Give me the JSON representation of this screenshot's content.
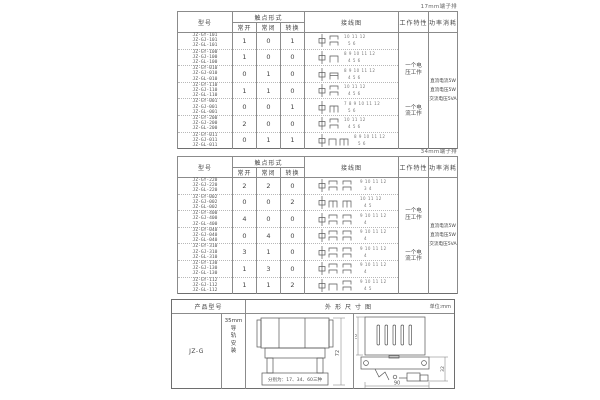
{
  "page": {
    "table1_tag": "17mm端子排",
    "table2_tag": "34mm端子排"
  },
  "headers": {
    "model": "型号",
    "contact_form": "触点形式",
    "normally_open": "常开",
    "normally_closed": "常闭",
    "changeover": "转换",
    "wiring_diagram": "接线图",
    "working_characteristic": "工作特性",
    "power_consumption": "功率消耗"
  },
  "table1": {
    "work_modes": [
      "一个电压工作",
      "一个电流工作"
    ],
    "power": [
      "直流电流5W",
      "直流电压5W",
      "交流电压5VA"
    ],
    "rows": [
      {
        "models": [
          "JZ-GY-101",
          "JZ-GJ-101",
          "JZ-GL-101"
        ],
        "no": 1,
        "nc": 0,
        "co": 1,
        "terminals_top": "10 11 12",
        "terminals_bottom": "5 6"
      },
      {
        "models": [
          "JZ-GY-100",
          "JZ-GJ-100",
          "JZ-GL-100"
        ],
        "no": 1,
        "nc": 0,
        "co": 0,
        "terminals_top": "8 9 10 11 12",
        "terminals_bottom": "4 5 6"
      },
      {
        "models": [
          "JZ-GY-010",
          "JZ-GJ-010",
          "JZ-GL-010"
        ],
        "no": 0,
        "nc": 1,
        "co": 0,
        "terminals_top": "8 9 10 11 12",
        "terminals_bottom": "4 5 6"
      },
      {
        "models": [
          "JZ-GY-110",
          "JZ-GJ-110",
          "JZ-GL-110"
        ],
        "no": 1,
        "nc": 1,
        "co": 0,
        "terminals_top": "10 11 12",
        "terminals_bottom": "4 5 6"
      },
      {
        "models": [
          "JZ-GY-001",
          "JZ-GJ-001",
          "JZ-GL-001"
        ],
        "no": 0,
        "nc": 0,
        "co": 1,
        "terminals_top": "7 8 9 10 11 12",
        "terminals_bottom": "5 6"
      },
      {
        "models": [
          "JZ-GY-200",
          "JZ-GJ-200",
          "JZ-GL-200"
        ],
        "no": 2,
        "nc": 0,
        "co": 0,
        "terminals_top": "10 11 12",
        "terminals_bottom": "4 5 6"
      },
      {
        "models": [
          "JZ-GY-011",
          "JZ-GJ-011",
          "JZ-GL-011"
        ],
        "no": 0,
        "nc": 1,
        "co": 1,
        "terminals_top": "8 9 10 11 12",
        "terminals_bottom": "5 6"
      }
    ]
  },
  "table2": {
    "work_modes": [
      "一个电压工作",
      "一个电流工作"
    ],
    "power": [
      "直流电流5W",
      "直流电压5W",
      "交流电压5VA"
    ],
    "rows": [
      {
        "models": [
          "JZ-GY-220",
          "JZ-GJ-220",
          "JZ-GL-220"
        ],
        "no": 2,
        "nc": 2,
        "co": 0,
        "terminals_top": "9 10 11 12",
        "terminals_bottom": "3 4"
      },
      {
        "models": [
          "JZ-GY-002",
          "JZ-GJ-002",
          "JZ-GL-002"
        ],
        "no": 0,
        "nc": 0,
        "co": 2,
        "terminals_top": "10 11 12",
        "terminals_bottom": "4 5"
      },
      {
        "models": [
          "JZ-GY-400",
          "JZ-GJ-400",
          "JZ-GL-400"
        ],
        "no": 4,
        "nc": 0,
        "co": 0,
        "terminals_top": "9 10 11 12",
        "terminals_bottom": "4"
      },
      {
        "models": [
          "JZ-GY-040",
          "JZ-GJ-040",
          "JZ-GL-040"
        ],
        "no": 0,
        "nc": 4,
        "co": 0,
        "terminals_top": "9 10 11 12",
        "terminals_bottom": "4"
      },
      {
        "models": [
          "JZ-GY-310",
          "JZ-GJ-310",
          "JZ-GL-310"
        ],
        "no": 3,
        "nc": 1,
        "co": 0,
        "terminals_top": "9 10 11 12",
        "terminals_bottom": "4"
      },
      {
        "models": [
          "JZ-GY-130",
          "JZ-GJ-130",
          "JZ-GL-130"
        ],
        "no": 1,
        "nc": 3,
        "co": 0,
        "terminals_top": "9 10 11 12",
        "terminals_bottom": "4"
      },
      {
        "models": [
          "JZ-GY-112",
          "JZ-GJ-112",
          "JZ-GL-112"
        ],
        "no": 1,
        "nc": 1,
        "co": 2,
        "terminals_top": "9 10 11 12",
        "terminals_bottom": "4 5"
      }
    ]
  },
  "bottom_table": {
    "product_model_header": "产品型号",
    "outline_header": "外形尺寸图",
    "unit": "单位:mm",
    "model": "JZ-G",
    "mounting": "35mm\n导\n轨\n安\n装",
    "front_view": {
      "height": 72,
      "caption": "分别为：17、34、60三种"
    },
    "side_view": {
      "height": 70,
      "side": 32,
      "width": 90
    }
  }
}
